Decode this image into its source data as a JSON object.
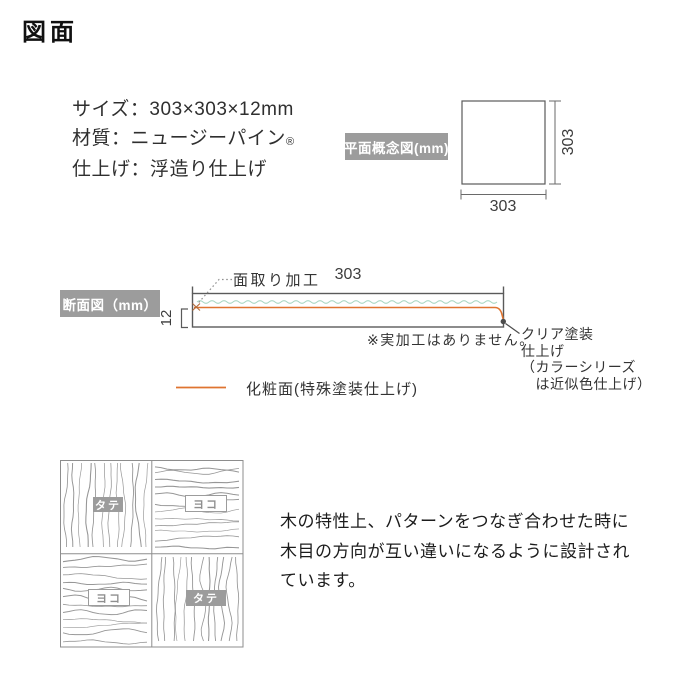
{
  "title": "図面",
  "specs": {
    "size": "サイズ：303×303×12mm",
    "material": "材質：ニュージーパイン",
    "material_mark": "®",
    "finish": "仕上げ：浮造り仕上げ"
  },
  "plan_view": {
    "label": "平面概念図(mm)",
    "dim_height": "303",
    "dim_width": "303"
  },
  "section_view": {
    "label": "断面図（mm）",
    "dim_width": "303",
    "dim_thickness": "12",
    "chamfer_label": "面取り加工",
    "note": "※実加工はありません。",
    "coating_label": "クリア塗装\n仕上げ\n（カラーシリーズ\n　は近似色仕上げ）",
    "legend_label": "化粧面(特殊塗装仕上げ)"
  },
  "pattern_diagram": {
    "badge_top_left": "タテ",
    "badge_top_right": "ヨコ",
    "badge_bottom_left": "ヨコ",
    "badge_bottom_right": "タテ",
    "description": "木の特性上、パターンをつなぎ合わせた時に\n木目の方向が互い違いになるように設計され\nています。"
  },
  "colors": {
    "label_box_bg": "#9c9c9c",
    "accent_orange": "#df7430",
    "texture_teal": "#a7d6c2",
    "line_gray": "#5a5a5a"
  }
}
